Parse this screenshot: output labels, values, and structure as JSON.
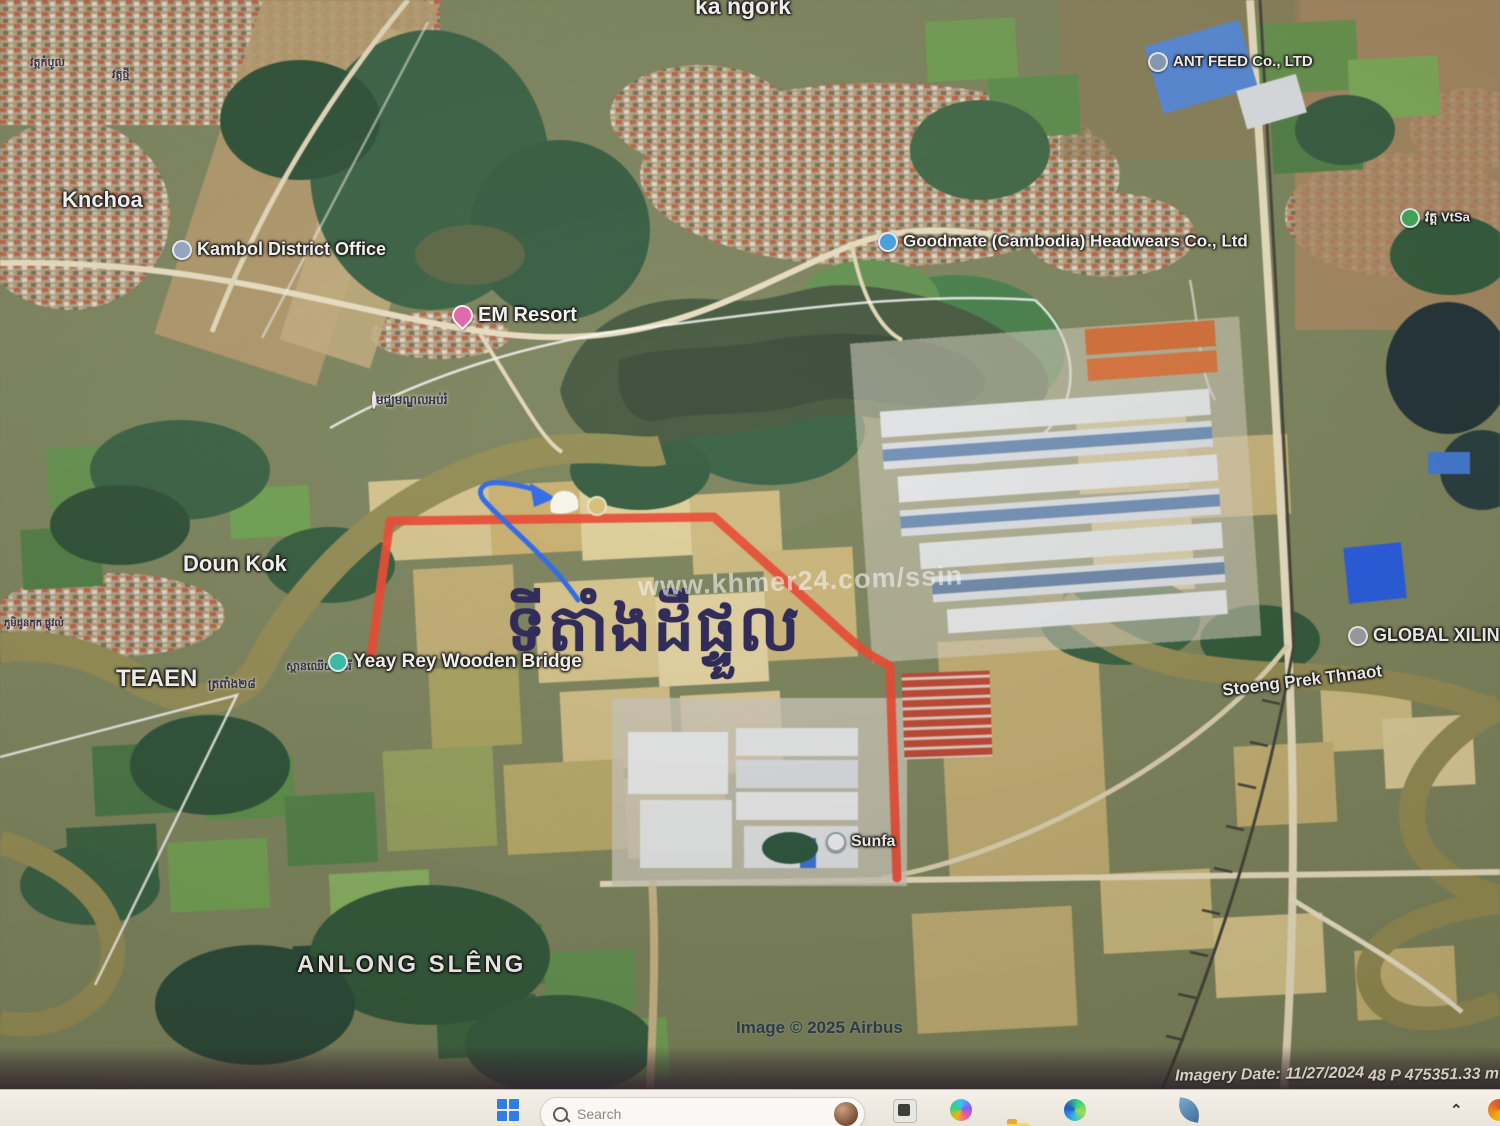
{
  "map": {
    "labels": {
      "ka_ngork": "ka ngork",
      "pagoda_left_1": "វត្តកំបូល",
      "pagoda_left_2": "វត្តថ្មី",
      "knchoa": "Knchoa",
      "kambol_district_office": "Kambol District Office",
      "em_resort": "EM Resort",
      "school_khmer": "មជ្ឈមណ្ឌលអប់រំ",
      "ant_feed": "ANT FEED Co., LTD",
      "goodmate": "Goodmate (Cambodia) Headwears Co., Ltd",
      "wat_right": "វត្ត VtSa",
      "doun_kok": "Doun Kok",
      "doun_kok_khmer": "ភូមិដូនកុក ផ្លូវលំ",
      "teaen": "TEAEN",
      "teaen_khmer": "ត្រពាំង២៨",
      "yeay_rey_khmer": "ស្ពានឈើយាយរី",
      "yeay_rey": "Yeay Rey Wooden Bridge",
      "global_xilin": "GLOBAL XILIN GA",
      "stoeng_prek_thnaot": "Stoeng Prek Thnaot",
      "sunfa": "Sunfa",
      "anlong_sleng": "ANLONG SLÊNG",
      "annotation_khmer": "ទីតាំងដីផ្ទួល",
      "watermark": "www.khmer24.com/ssin",
      "copyright": "Image © 2025 Airbus"
    },
    "statusbar": {
      "imagery_date": "Imagery Date: 11/27/2024",
      "coordinates": "48 P 475351.33 m E 12665"
    },
    "annotation_colors": {
      "plot_outline": "#e8432c",
      "arrow": "#2563eb",
      "khmer_text": "#1f1a52"
    }
  },
  "taskbar": {
    "search_placeholder": "Search"
  }
}
